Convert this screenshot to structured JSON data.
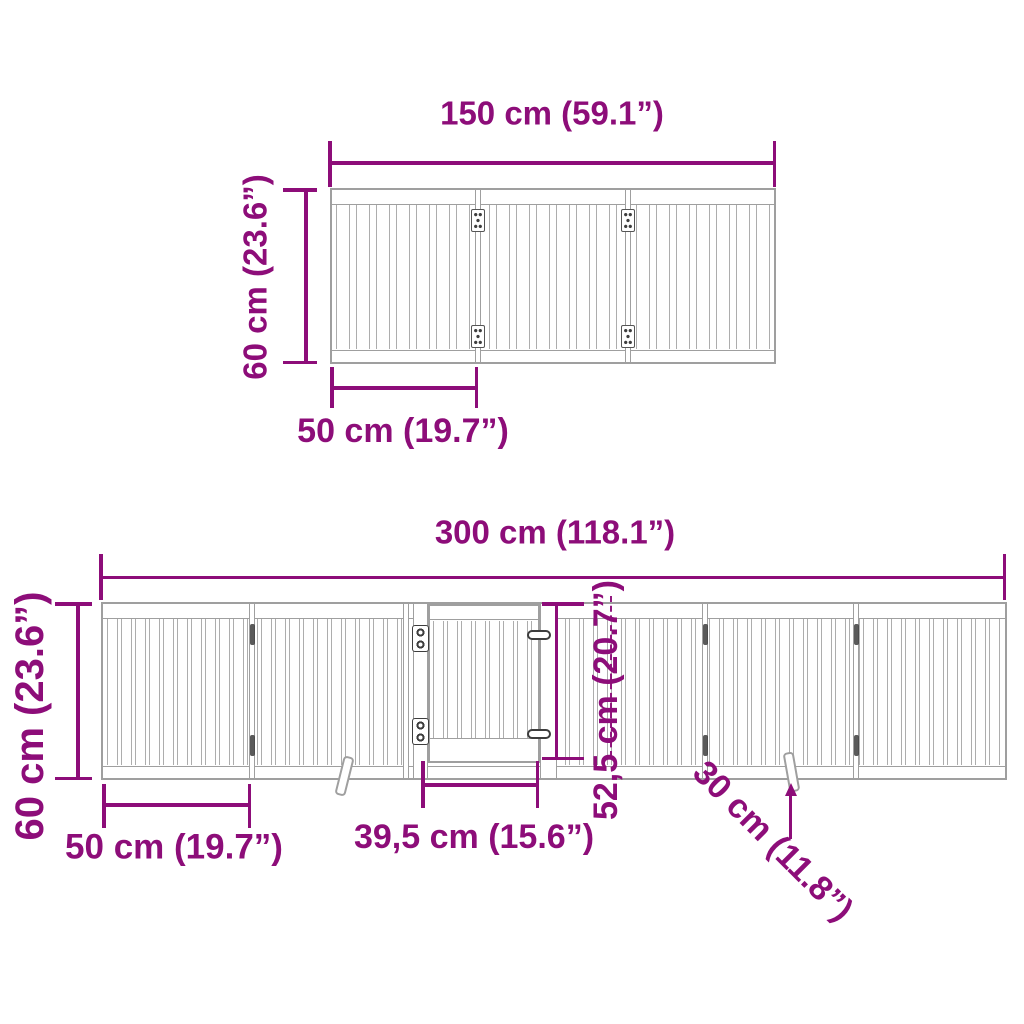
{
  "diagram": {
    "title": "foldable pet gate dimension diagram",
    "accent_color": "#8d0d79",
    "line_color": "#9f9f9f",
    "top_gate": {
      "name": "3-panel gate, folded configuration, front view",
      "panel_count": 3,
      "width_label": "150 cm (59.1”)",
      "height_label": "60 cm (23.6”)",
      "panel_width_label": "50 cm (19.7”)"
    },
    "bottom_gate": {
      "name": "6-panel gate with door, extended configuration, front view",
      "panel_count": 6,
      "width_label": "300 cm (118.1”)",
      "height_label": "60 cm (23.6”)",
      "panel_width_label": "50 cm (19.7”)",
      "door_width_label": "39,5 cm (15.6”)",
      "door_height_label": "52,5 cm (20.7”)",
      "foot_height_label": "30 cm (11.8”)"
    }
  }
}
